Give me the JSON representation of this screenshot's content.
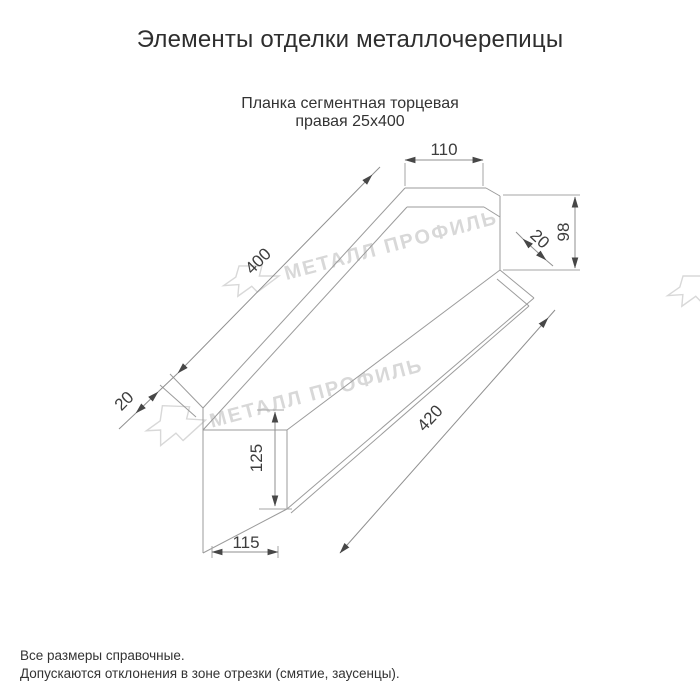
{
  "page": {
    "title": "Элементы отделки металлочерепицы",
    "subtitle_line1": "Планка сегментная торцевая",
    "subtitle_line2": "правая 25х400",
    "note_line1": "Все размеры справочные.",
    "note_line2": "Допускаются отклонения в зоне отрезки (смятие, заусенцы)."
  },
  "drawing": {
    "type": "axonometric technical drawing of right segmental end strip 25x400",
    "dimensions": {
      "top_flange_width": "110",
      "end_web_height": "98",
      "top_hem": "20",
      "top_edge_length": "400",
      "bottom_edge_length": "420",
      "bottom_hem": "20",
      "end_face_height": "125",
      "end_face_width": "115"
    },
    "colors": {
      "outline": "#9b9b9b",
      "dimension_text": "#3d3d3d",
      "arrowhead": "#474747",
      "watermark": "#d8d8d8"
    }
  },
  "watermark": {
    "text": "МЕТАЛЛ ПРОФИЛЬ",
    "logo": "metall-profil-arrow-logo"
  }
}
